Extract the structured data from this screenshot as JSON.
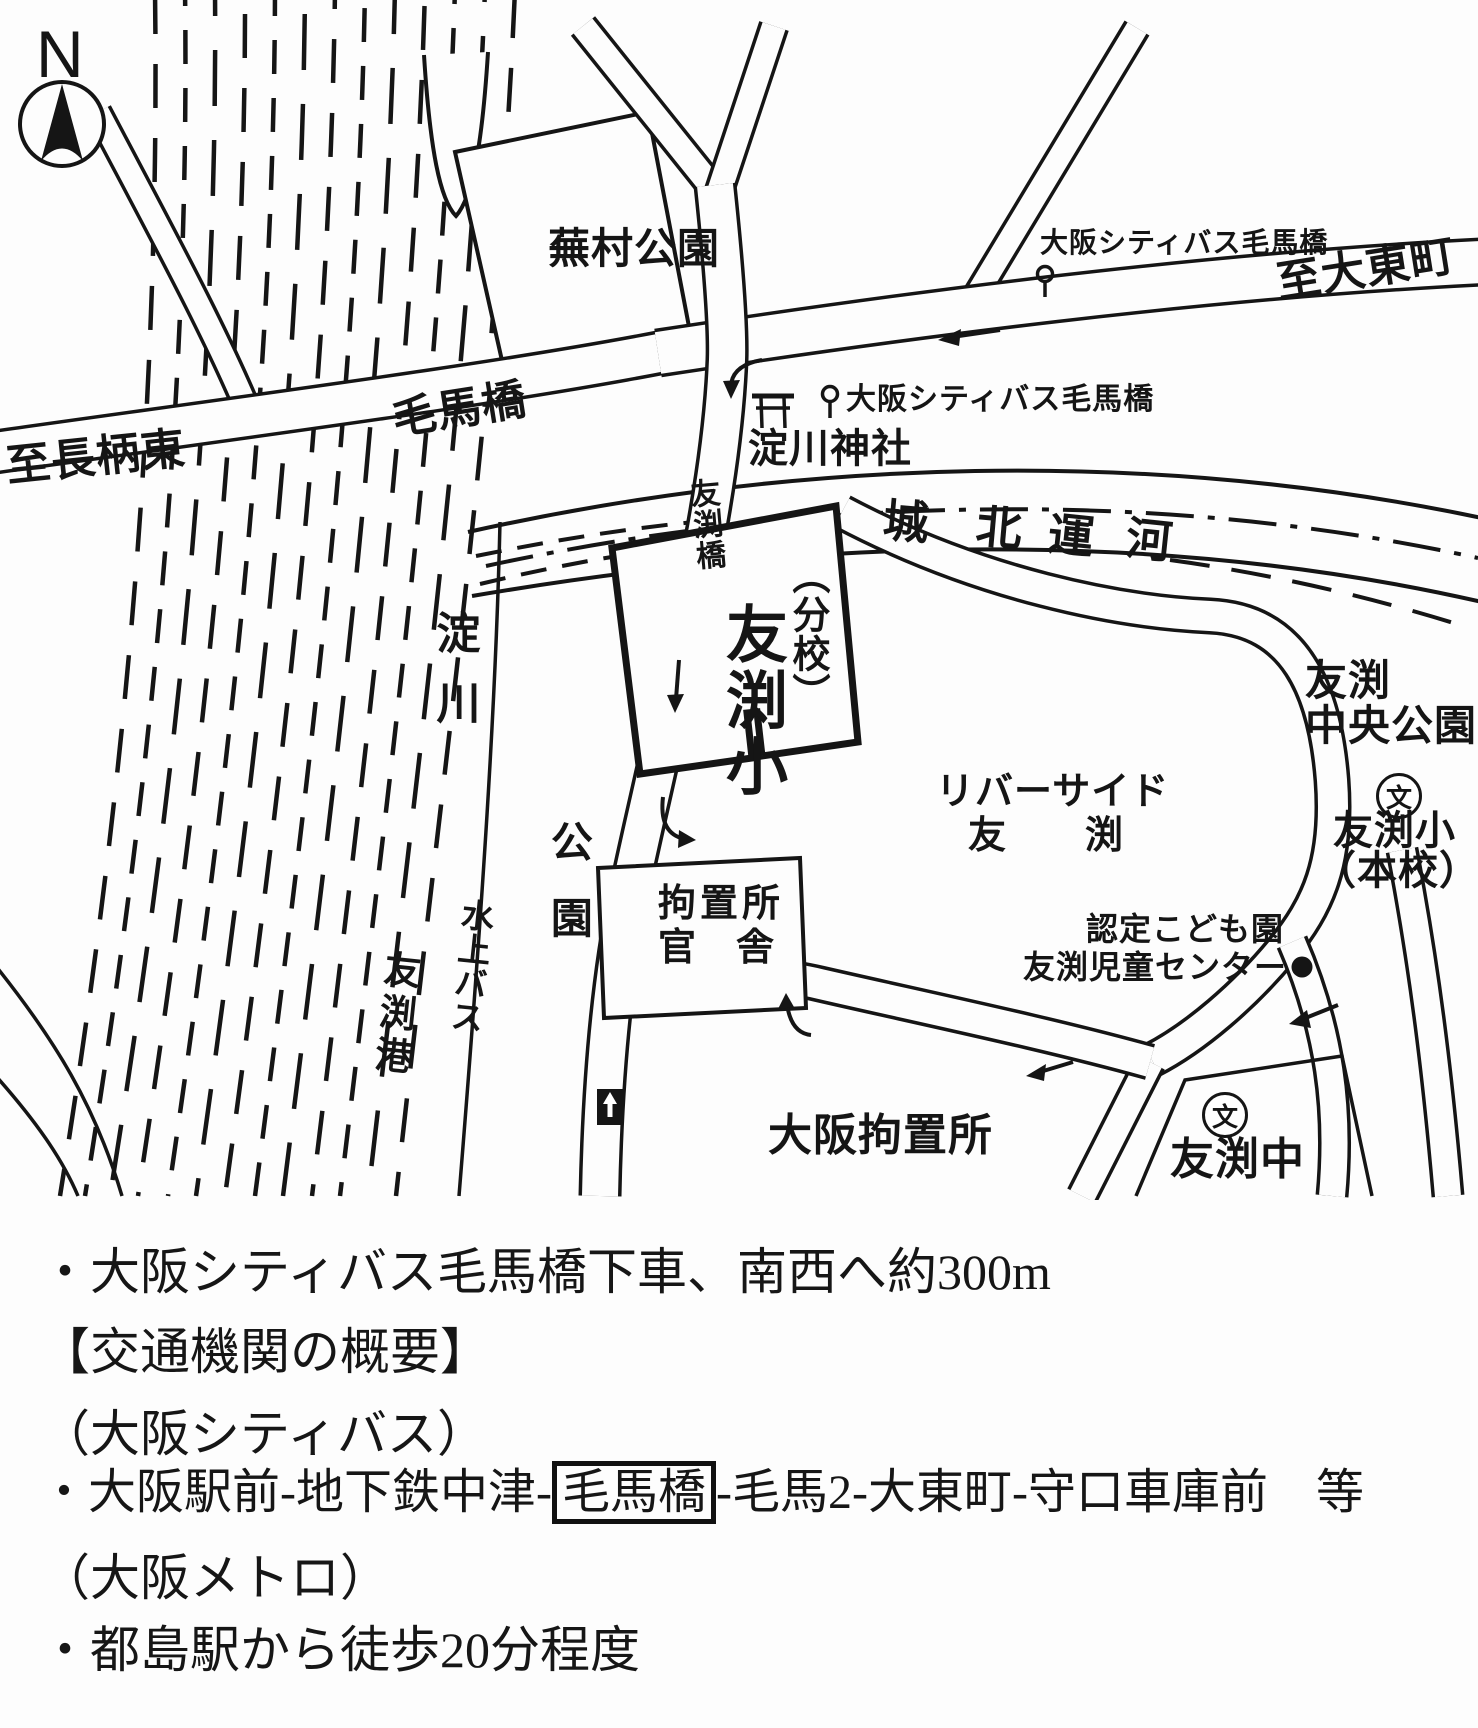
{
  "map": {
    "compass": {
      "label": "N"
    },
    "roads": {
      "kemabashi_label": "毛馬橋",
      "to_nagara_higashi": "至長柄東",
      "to_daito_cho": "至大東町",
      "tomobuchi_bridge": "友渕橋"
    },
    "bus_stops": {
      "top_label": "大阪シティバス毛馬橋",
      "middle_label": "大阪シティバス毛馬橋"
    },
    "places": {
      "buson_park": "蕪村公園",
      "yodogawa_shrine": "淀川神社",
      "shirokita_canal": [
        "城",
        "北",
        "運",
        "河"
      ],
      "branch_school_paren": "（分校）",
      "branch_school_name": "友渕小",
      "riverside_line1": "リバーサイド",
      "riverside_line2": "友　　渕",
      "central_park_line1": "友渕",
      "central_park_line2": "中央公園",
      "school_mark_char": "文",
      "main_school_line1": "友渕小",
      "main_school_line2": "（本校）",
      "kodomoen_line1": "認定こども園",
      "kodomoen_line2": "友渕児童センター",
      "detention_housing_line1": "拘置所",
      "detention_housing_line2": "官　舎",
      "park_vertical": "公園",
      "osaka_detention": "大阪拘置所",
      "tomobuchi_jhs": "友渕中",
      "yodo_river": "淀川",
      "water_bus": "水上バス",
      "tomobuchi_port": "友渕港"
    }
  },
  "notes": {
    "line1": "・大阪シティバス毛馬橋下車、南西へ約300m",
    "line2": "【交通機関の概要】",
    "line3": "（大阪シティバス）",
    "line4_pre": "・大阪駅前-地下鉄中津-",
    "line4_boxed": "毛馬橋",
    "line4_post": "-毛馬2-大東町-守口車庫前　等",
    "line5": "（大阪メトロ）",
    "line6": "・都島駅から徒歩20分程度"
  },
  "colors": {
    "ink": "#151515",
    "paper": "#ffffff"
  }
}
